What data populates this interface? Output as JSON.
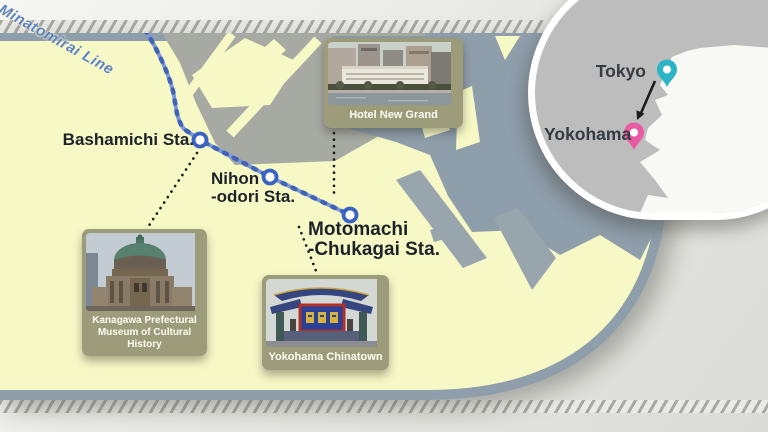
{
  "map": {
    "line_label": "Minatomirai Line",
    "stations": {
      "bashamichi": {
        "label": "Bashamichi Sta."
      },
      "nihon_odori": {
        "line1": "Nihon",
        "line2": "-odori Sta."
      },
      "motomachi_chukagai": {
        "line1": "Motomachi",
        "line2": "-Chukagai Sta."
      }
    }
  },
  "landmarks": {
    "hotel": {
      "caption": "Hotel New Grand"
    },
    "museum": {
      "caption_line1": "Kanagawa Prefectural",
      "caption_line2": "Museum of Cultural History"
    },
    "chinatown": {
      "caption": "Yokohama Chinatown"
    }
  },
  "inset": {
    "tokyo_label": "Tokyo",
    "yokohama_label": "Yokohama"
  },
  "colors": {
    "land": "#f6f8c6",
    "water": "#8f9eab",
    "city_blocks": "#a7aaa3",
    "rail_line": "#7d97d4",
    "rail_dash": "#3f63b8",
    "station_ring": "#3a62c0",
    "line_label_blue": "#5f82c6",
    "station_label": "#1d2328",
    "photo_card_frame": "#9c9c7b",
    "inset_background": "#bdbdbd",
    "inset_land": "#f8f8f5",
    "tokyo_pin": "#2ab4c6",
    "yokohama_pin": "#e85ba3"
  }
}
